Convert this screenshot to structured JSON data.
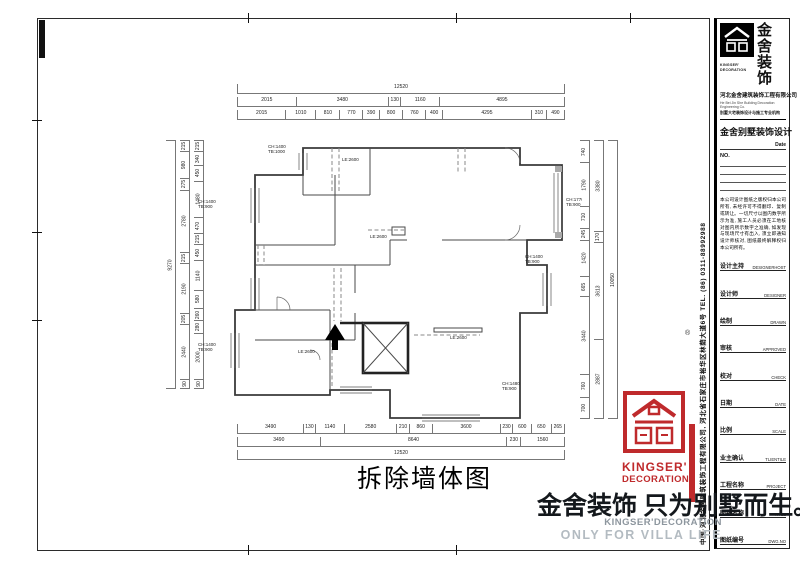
{
  "sheet": {
    "drawing_title": "拆除墙体图",
    "slogan_cn": "金舍装饰 只为别墅而生。",
    "slogan_en1": "KINGSER'DECORATION",
    "slogan_en2": "ONLY FOR VILLA LIFE"
  },
  "brand": {
    "red": "#bf2a2c",
    "logo_cn_1": "金舍",
    "logo_cn_2": "装饰",
    "logo_en_1": "KINGSER'",
    "logo_en_2": "DECORATION",
    "company_cn": "河北金舍建筑装饰工程有限公司",
    "company_en": "He Bei Jin She Building Decoration Engineering Co.",
    "company_sub": "别墅大宅装饰设计与施工专业机构",
    "studio_title": "金舍别墅装饰设计",
    "side_strip": "中国·河北金舍建筑装饰工程有限公司, 河北省石家庄市裕华区林荫大道6号  TEL. (86) 0311-88992988",
    "reg_mark": "®"
  },
  "titleblock": {
    "date_label": "Date",
    "no_label": "NO.",
    "disclaimer": "本公司设计图纸之版权归本公司所有, 未经许可不得翻印、复制或转让。一切尺寸以图内数字所示为准, 施工人员必须在工地核对图内所示数字之准确, 如发现与现场尺寸有出入, 须立即通知设计师核对, 图纸最终解释权归本公司所有。",
    "fields": [
      {
        "cn": "设计主持",
        "en": "DESIGNERHOST"
      },
      {
        "cn": "设计师",
        "en": "DESIGNER"
      },
      {
        "cn": "绘制",
        "en": "DRAWN"
      },
      {
        "cn": "审核",
        "en": "APPROVED"
      },
      {
        "cn": "校对",
        "en": "CHECK"
      },
      {
        "cn": "日期",
        "en": "DATE"
      },
      {
        "cn": "比例",
        "en": "SCALE"
      },
      {
        "cn": "业主确认",
        "en": "TLIENTILE"
      },
      {
        "cn": "工程名称",
        "en": "PROJECT"
      },
      {
        "cn": "图纸名称",
        "en": "TITLE"
      },
      {
        "cn": "图纸编号",
        "en": "DWG.NO"
      }
    ]
  },
  "plan": {
    "labels": [
      {
        "text": "LE:2600",
        "x": 120,
        "y": 33
      },
      {
        "text": "LE:2600",
        "x": 148,
        "y": 110
      },
      {
        "text": "LE:2600",
        "x": 76,
        "y": 225
      },
      {
        "text": "LE:2600",
        "x": 228,
        "y": 211
      },
      {
        "text": "CH:1400",
        "x": 46,
        "y": 20
      },
      {
        "text": "TB:1000",
        "x": 46,
        "y": 25
      },
      {
        "text": "CH:1400",
        "x": -24,
        "y": 75
      },
      {
        "text": "TB:900",
        "x": -24,
        "y": 80
      },
      {
        "text": "CH:1400",
        "x": -24,
        "y": 218
      },
      {
        "text": "TB:900",
        "x": -24,
        "y": 223
      },
      {
        "text": "CH:1770",
        "x": 344,
        "y": 73
      },
      {
        "text": "TB:900",
        "x": 344,
        "y": 78
      },
      {
        "text": "CH:1400",
        "x": 303,
        "y": 130
      },
      {
        "text": "TB:900",
        "x": 303,
        "y": 135
      },
      {
        "text": "CH:1480",
        "x": 280,
        "y": 257
      },
      {
        "text": "TB:900",
        "x": 280,
        "y": 262
      }
    ],
    "dims": {
      "top": [
        [
          "12520"
        ],
        [
          "2015",
          "3480",
          "130",
          "1160",
          "4895"
        ],
        [
          "2015",
          "1010",
          "810",
          "770",
          "390",
          "800",
          "760",
          "400",
          "4295",
          "310",
          "490"
        ]
      ],
      "bottom": [
        [
          "3490",
          "130",
          "1140",
          "2580",
          "210",
          "860",
          "3600",
          "230",
          "600",
          "650",
          "265"
        ],
        [
          "3490",
          "8640",
          "230",
          "1560"
        ],
        [
          "12520"
        ]
      ],
      "left": [
        [
          "9270"
        ],
        [
          "215",
          "980",
          "275",
          "2780",
          "215",
          "2190",
          "205",
          "2440",
          "90"
        ],
        [
          "215",
          "340",
          "450",
          "1480",
          "470",
          "215",
          "450",
          "1140",
          "580",
          "260",
          "280",
          "2000",
          "90"
        ]
      ],
      "right": [
        [
          "740",
          "1790",
          "710",
          "245",
          "1420",
          "665",
          "3440",
          "760",
          "700"
        ],
        [
          "3380",
          "170",
          "3613",
          "2887"
        ],
        [
          "10050"
        ]
      ]
    }
  }
}
